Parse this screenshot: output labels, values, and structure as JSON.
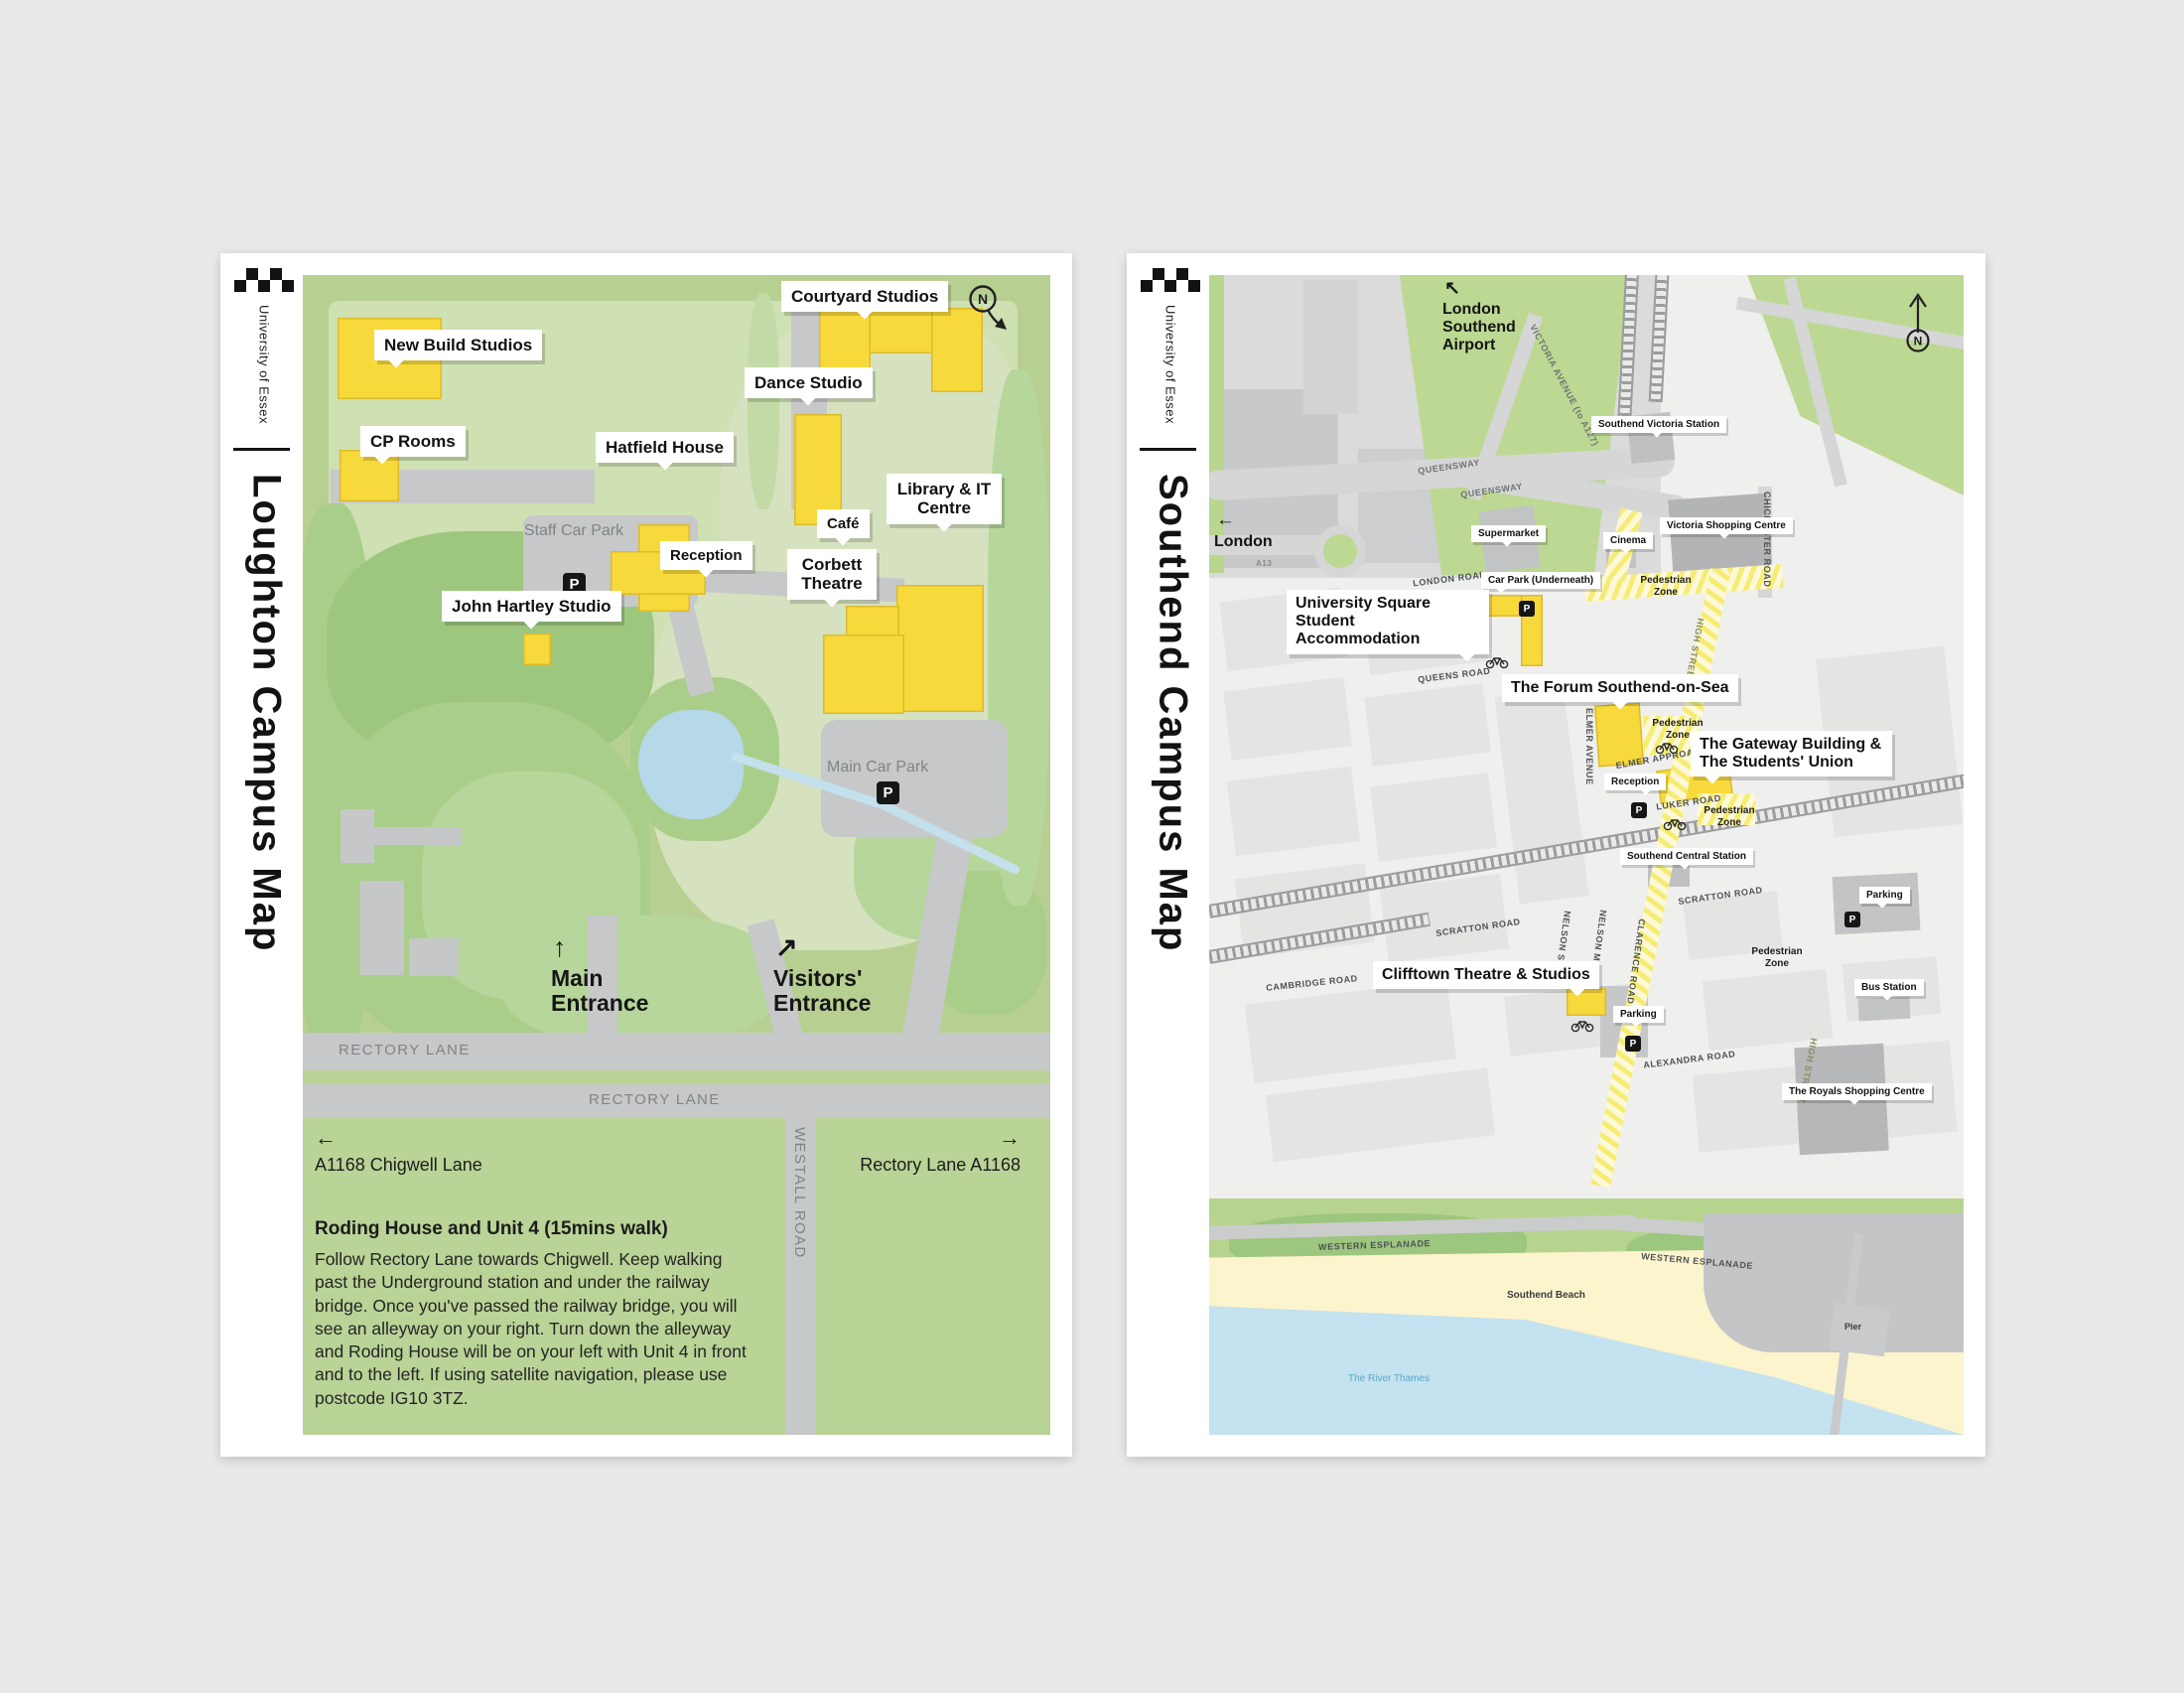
{
  "brand": {
    "name": "University of Essex"
  },
  "icons": {
    "north": "N",
    "parking": "P"
  },
  "arrows": {
    "up": "↑",
    "up_right": "↗",
    "left": "←",
    "right": "→",
    "up_left": "↖"
  },
  "loughton": {
    "title": "Loughton Campus Map",
    "callouts": {
      "new_build": "New Build Studios",
      "cp_rooms": "CP Rooms",
      "courtyard": "Courtyard Studios",
      "dance": "Dance Studio",
      "hatfield": "Hatfield House",
      "reception": "Reception",
      "john_hartley": "John Hartley Studio",
      "library": "Library & IT Centre",
      "cafe": "Café",
      "corbett": "Corbett Theatre"
    },
    "map_labels": {
      "staff_car_park": "Staff Car Park",
      "main_car_park": "Main Car Park",
      "rectory_lane": "RECTORY LANE",
      "westall_road": "WESTALL ROAD"
    },
    "entrances": {
      "main": "Main Entrance",
      "visitors": "Visitors' Entrance"
    },
    "wayfinding": {
      "chigwell": "A1168 Chigwell Lane",
      "rectory_a1168": "Rectory Lane A1168"
    },
    "directions": {
      "heading": "Roding House and Unit 4 (15mins walk)",
      "body": "Follow Rectory Lane towards Chigwell. Keep walking past the Underground station and under the railway bridge. Once you've passed the railway bridge, you will see an alleyway on your right. Turn down the alleyway and Roding House will be on your left with Unit 4 in front and to the left. If using satellite navigation, please use postcode IG10 3TZ."
    }
  },
  "southend": {
    "title": "Southend Campus Map",
    "callouts": {
      "victoria_station": "Southend Victoria Station",
      "supermarket": "Supermarket",
      "cinema": "Cinema",
      "victoria_shopping": "Victoria Shopping Centre",
      "car_park_underneath": "Car Park (Underneath)",
      "university_square": "University Square Student Accommodation",
      "forum": "The Forum Southend-on-Sea",
      "gateway": "The Gateway Building & The Students' Union",
      "reception": "Reception",
      "central_station": "Southend Central Station",
      "clifftown": "Clifftown Theatre & Studios",
      "parking": "Parking",
      "bus_station": "Bus Station",
      "royals": "The Royals Shopping Centre"
    },
    "zones": {
      "pedestrian": "Pedestrian Zone"
    },
    "roads": {
      "queensway": "QUEENSWAY",
      "victoria_avenue": "VICTORIA AVENUE (to A127)",
      "chichester": "CHICHESTER ROAD",
      "london_road": "LONDON ROAD",
      "queens_road": "QUEENS ROAD",
      "elmer_avenue": "ELMER AVENUE",
      "elmer_approach": "ELMER APPROACH",
      "luker_road": "LUKER ROAD",
      "high_street": "HIGH STREET",
      "scratton": "SCRATTON ROAD",
      "cambridge": "CAMBRIDGE ROAD",
      "nelson_st": "NELSON ST.",
      "nelson_mews": "NELSON MEWS",
      "clarence": "CLARENCE ROAD",
      "alexandra": "ALEXANDRA ROAD",
      "western_esplanade": "WESTERN ESPLANADE",
      "a13": "A13"
    },
    "places": {
      "airport": "London Southend Airport",
      "london": "London",
      "beach": "Southend Beach",
      "thames": "The River Thames",
      "pier": "Pier"
    }
  }
}
